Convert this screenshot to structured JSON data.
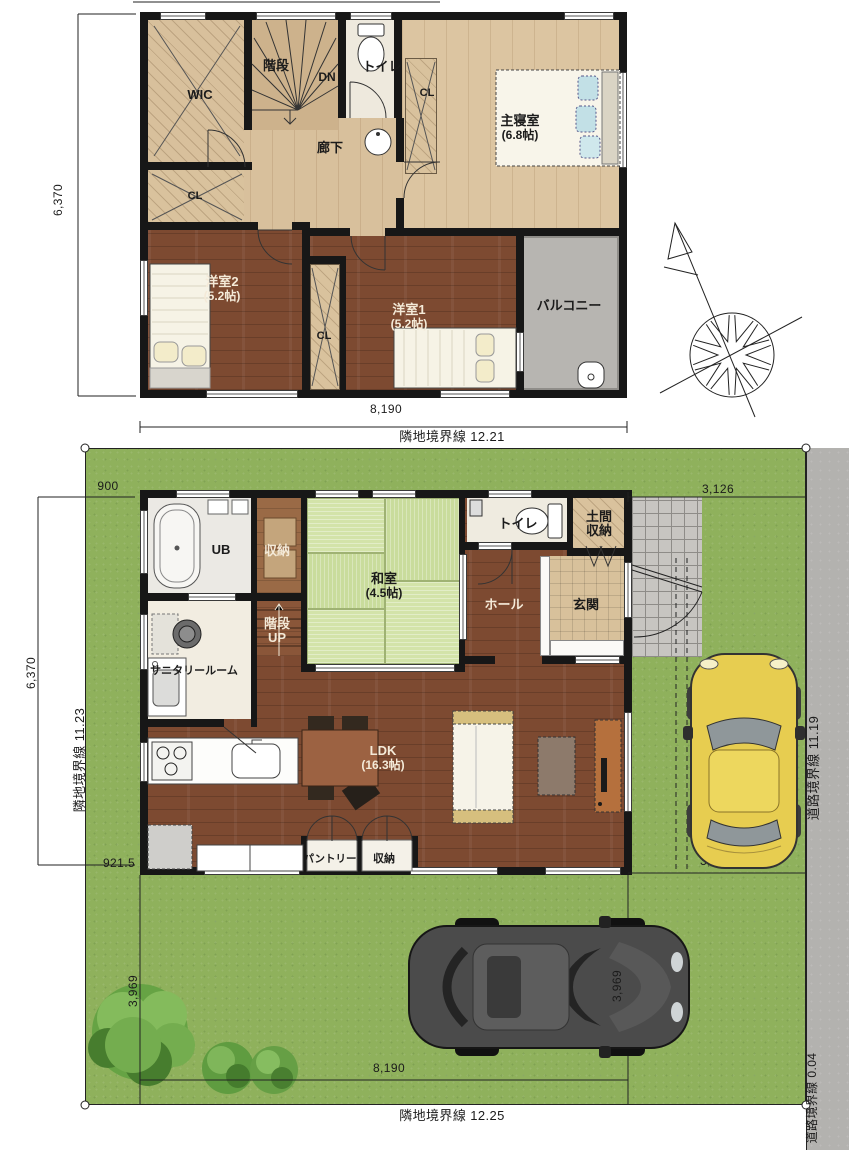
{
  "floor2": {
    "rooms": {
      "wic": "WIC",
      "stairs": "階段",
      "dn": "DN",
      "toilet": "トイレ",
      "cl": "CL",
      "hallway": "廊下",
      "master": "主寝室",
      "master_size": "(6.8帖)",
      "room2": "洋室2",
      "room2_size": "(5.2帖)",
      "room1": "洋室1",
      "room1_size": "(5.2帖)",
      "balcony": "バルコニー"
    },
    "dims": {
      "left": "6,370",
      "bottom": "8,190"
    }
  },
  "floor1": {
    "rooms": {
      "ub": "UB",
      "storage": "収納",
      "washitsu": "和室",
      "washitsu_size": "(4.5帖)",
      "toilet": "トイレ",
      "doma_top": "土間",
      "doma_bottom": "収納",
      "hall": "ホール",
      "genkan": "玄関",
      "stairs": "階段",
      "stairs_dir": "UP",
      "sanitary": "サニタリールーム",
      "ldk": "LDK",
      "ldk_size": "(16.3帖)",
      "pantry": "パントリー"
    }
  },
  "site": {
    "boundaries": {
      "top": "隣地境界線 12.21",
      "left": "隣地境界線 11.23",
      "right": "道路境界線 11.19",
      "bottom": "隣地境界線 12.25",
      "bottom_right": "道路境界線 0.04"
    },
    "dims": {
      "top_left": "900",
      "top_right": "3,126",
      "left": "6,370",
      "left_bottom": "921.5",
      "right_bottom": "3,126",
      "bottom": "8,190",
      "tree": "3,969",
      "car": "3,969"
    }
  }
}
